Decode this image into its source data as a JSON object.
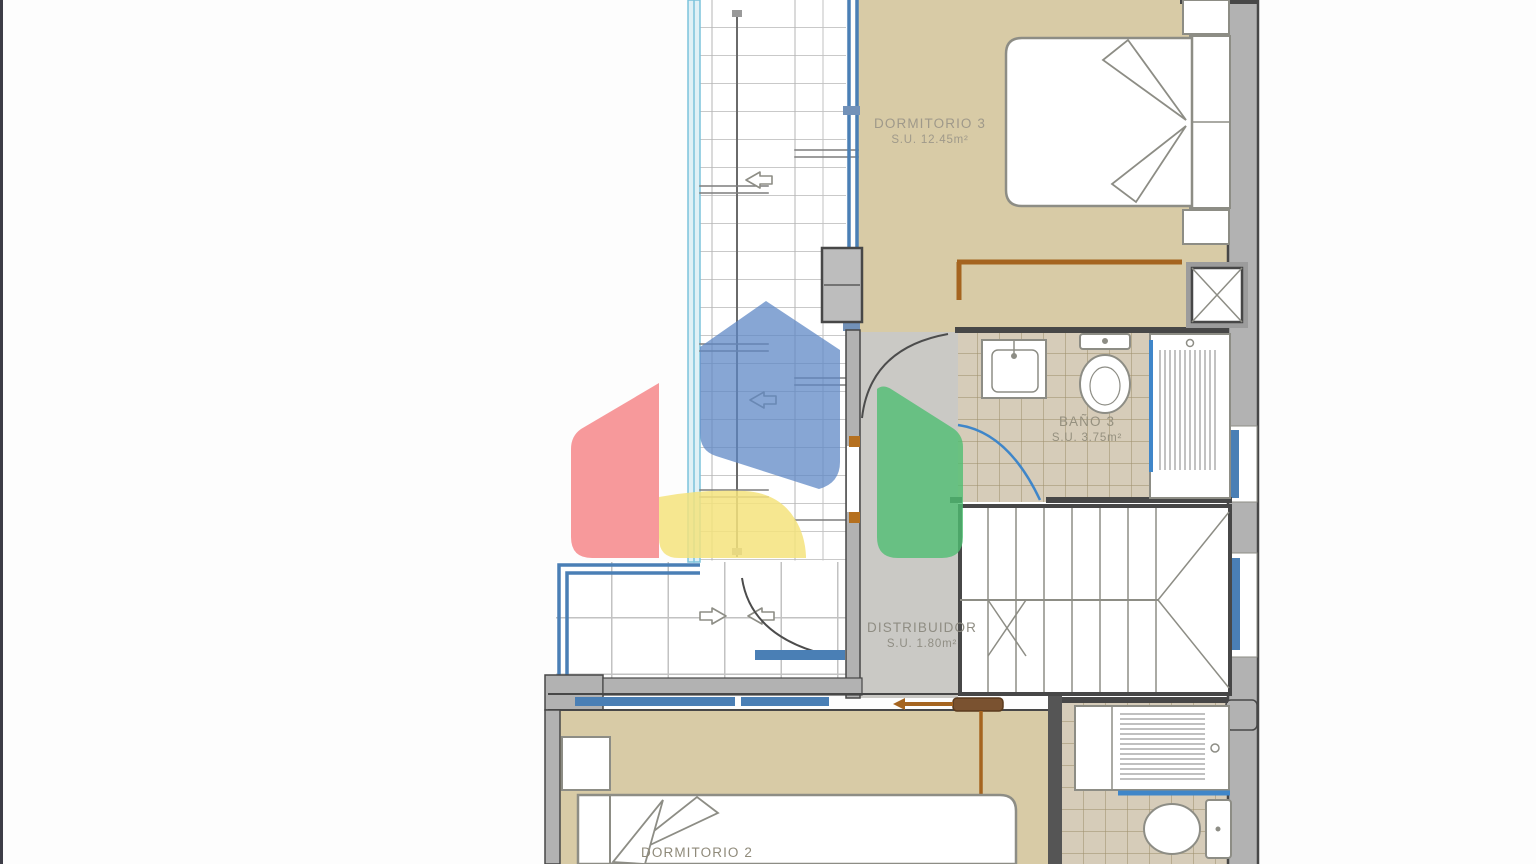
{
  "rooms": {
    "dormitorio3": {
      "name": "DORMITORIO 3",
      "area": "S.U. 12.45m²"
    },
    "bano3": {
      "name": "BAÑO 3",
      "area": "S.U. 3.75m²"
    },
    "distribuidor": {
      "name": "DISTRIBUIDOR",
      "area": "S.U. 1.80m²"
    },
    "dormitorio2": {
      "name": "DORMITORIO 2"
    }
  },
  "watermark": {
    "shape": "house-logo",
    "colors": {
      "roof_blue": "#5d87c5",
      "left_red": "#f57f82",
      "base_yellow": "#f4e37c",
      "right_green": "#4fbe72"
    }
  },
  "icons": {
    "direction_arrow_left": "⇦",
    "direction_arrow_right": "⇨",
    "shaft_marker": "X"
  },
  "palette": {
    "floor_beige": "#d8cba6",
    "floor_tile": "#d6ccb9",
    "floor_gray": "#cac9c5",
    "wall_gray": "#b2b2b2",
    "wall_dark": "#474747",
    "window_blue": "#4a7fb5",
    "glazing_cyan": "#7cc3dc",
    "door_arc_blue": "#3f86c9",
    "wood_brown": "#a5641f"
  }
}
